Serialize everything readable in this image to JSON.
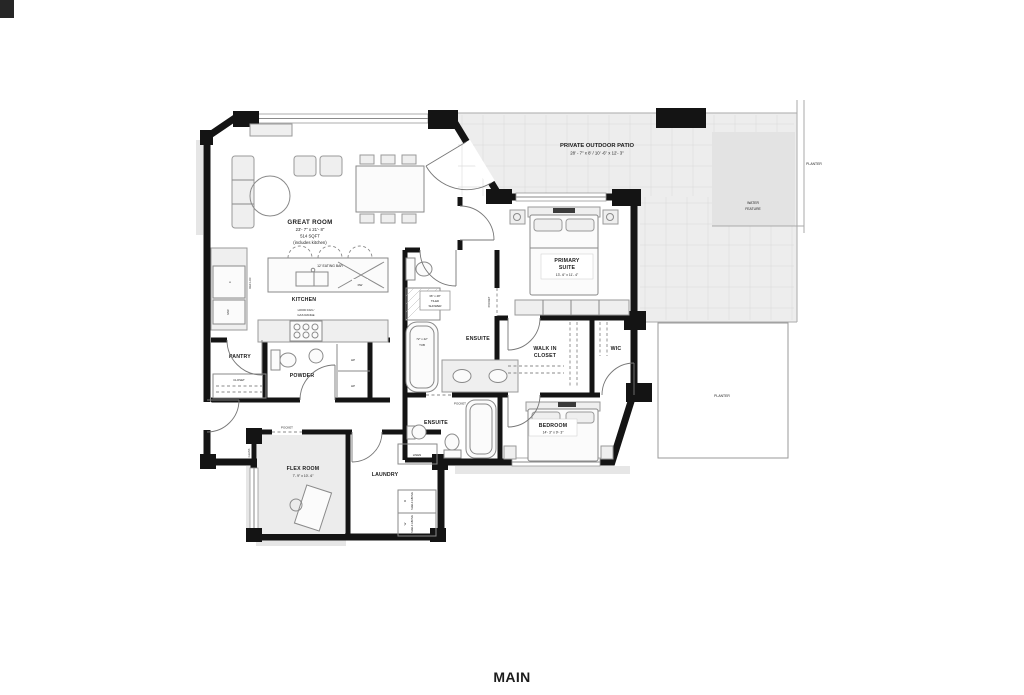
{
  "footer": {
    "label": "MAIN"
  },
  "outdoor": {
    "patio_title": "PRIVATE OUTDOOR PATIO",
    "patio_dims": "28' - 7\" x 8' / 10' -6\" x 12'- 3\"",
    "planter_upper": "PLANTER",
    "planter_lower": "PLANTER",
    "water_feature": [
      "WATER",
      "FEATURE"
    ]
  },
  "great_room": {
    "name": "GREAT ROOM",
    "dims": "23'- 7\" x 21'- 8\"",
    "area": "514 SQFT",
    "note": "(includes kitchen)"
  },
  "kitchen": {
    "name": "KITCHEN",
    "eating_bar": "12' EATING BAR",
    "hood1": "HOOD FAN /",
    "hood2": "GAS RANGE",
    "dw": "DW",
    "fridge": "F",
    "ref_loc": "REF LOC",
    "microwave": "MW"
  },
  "utility": {
    "pantry": "PANTRY",
    "closet": "CLOSET",
    "powder": "POWDER",
    "hp_upper": "HP",
    "hp_lower": "HP",
    "linen": "LINEN",
    "laundry": "LAUNDRY",
    "washer": "W",
    "dryer": "D",
    "shelf_above_w": "SHELF ABOVE",
    "shelf_above_d": "SHELF ABOVE"
  },
  "flex_room": {
    "name": "FLEX ROOM",
    "dims": "7'- 9\" x 10'- 6\"",
    "pocket": "POCKET",
    "glass": "GLASS"
  },
  "ensuite_main": {
    "name": "ENSUITE",
    "shower1": "36\" x 48\"",
    "shower2": "TILED",
    "shower3": "SHOWER",
    "tub1": "72\" x 42\"",
    "tub2": "TUB",
    "pocket": "POCKET"
  },
  "primary_suite": {
    "name1": "PRIMARY",
    "name2": "SUITE",
    "dims": "13'- 6\" x 11'- 4\""
  },
  "closets": {
    "walk_in1": "WALK IN",
    "walk_in2": "CLOSET",
    "wic": "WIC"
  },
  "ensuite_second": {
    "name": "ENSUITE",
    "pocket": "POCKET"
  },
  "bedroom": {
    "name": "BEDROOM",
    "dims": "14'- 3\" x 9'- 3\""
  }
}
